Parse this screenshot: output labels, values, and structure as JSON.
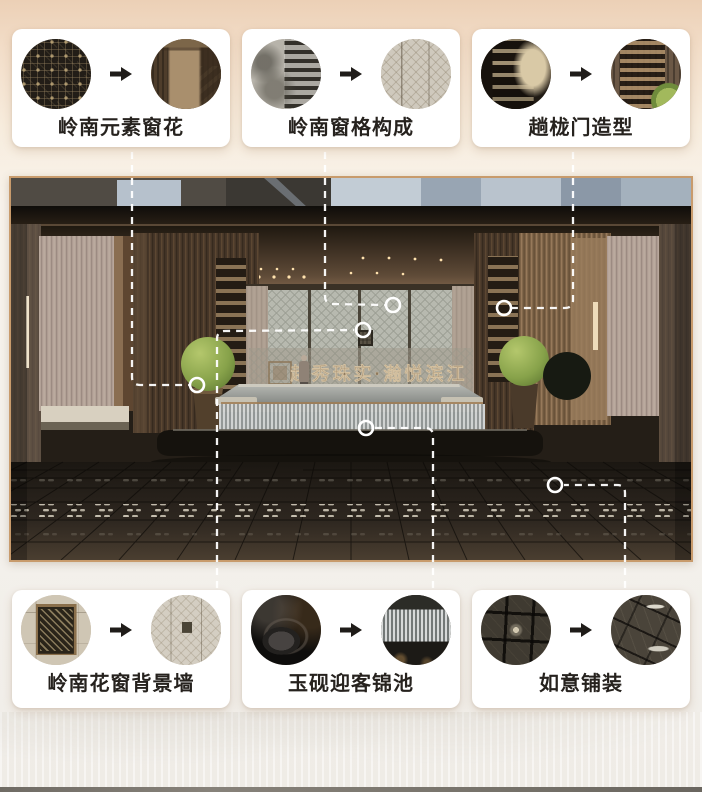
{
  "cards": [
    {
      "id": "lingnan-window-flower",
      "label": "岭南元素窗花",
      "before_photo": "lingnan-lattice-pattern-photo",
      "after_photo": "bronze-perforated-column-photo"
    },
    {
      "id": "lingnan-lattice-composition",
      "label": "岭南窗格构成",
      "before_photo": "old-lingnan-windows-photo",
      "after_photo": "diamond-lattice-wall-photo"
    },
    {
      "id": "tanglong-door-shape",
      "label": "趟栊门造型",
      "before_photo": "traditional-tanglong-door-photo",
      "after_photo": "tanglong-screen-with-topiary-photo"
    },
    {
      "id": "lingnan-flower-window-wall",
      "label": "岭南花窗背景墙",
      "before_photo": "flower-window-on-wall-photo",
      "after_photo": "feature-wall-with-emblem-photo"
    },
    {
      "id": "jade-inkstone-pool",
      "label": "玉砚迎客锦池",
      "before_photo": "ink-stone-photo",
      "after_photo": "water-curtain-pool-photo"
    },
    {
      "id": "ruyi-paving",
      "label": "如意铺装",
      "before_photo": "grid-paving-photo",
      "after_photo": "ruyi-pattern-paving-photo"
    }
  ],
  "icons": {
    "arrow": "arrow-right-icon",
    "callout_marker": "circle-marker-icon"
  },
  "scene": {
    "name": "entrance-courtyard-rendering",
    "calligraphy": "越秀珠实·瀚悦滨江"
  },
  "colors": {
    "background_top": "#ecd0b6",
    "card_background": "#ffffff",
    "label_text": "#26221e",
    "frame_border": "#c89b6c",
    "connector": "#ffffff",
    "topiary_green": "#8fa854"
  }
}
